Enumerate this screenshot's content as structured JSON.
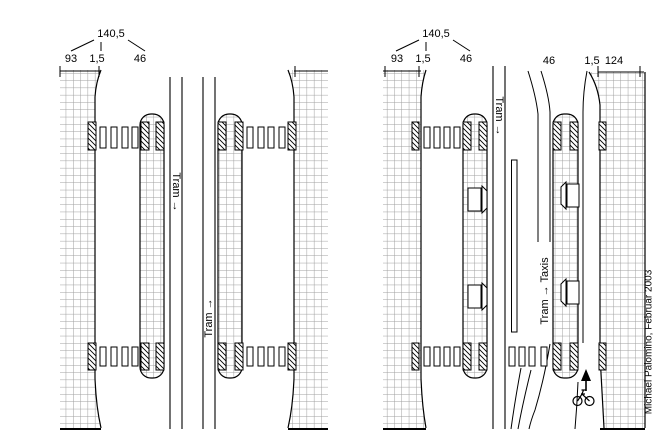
{
  "left_diagram": {
    "dimension_total": "140,5",
    "dimension_parts": [
      "93",
      "1,5",
      "46"
    ],
    "tram_down_label": "Tram →",
    "tram_up_label": "Tram →"
  },
  "right_diagram": {
    "dimension_total": "140,5",
    "dimension_parts": [
      "93",
      "1,5",
      "46"
    ],
    "right_dimension_parts": [
      "46",
      "1,5",
      "124"
    ],
    "tram_down_label": "Tram →",
    "tram_taxi_up_label": "Tram → Taxis"
  },
  "signature": "Michael Palomino, Februar 2003",
  "colors": {
    "line": "#000000",
    "grid": "#9f9f9f",
    "background": "#ffffff"
  }
}
